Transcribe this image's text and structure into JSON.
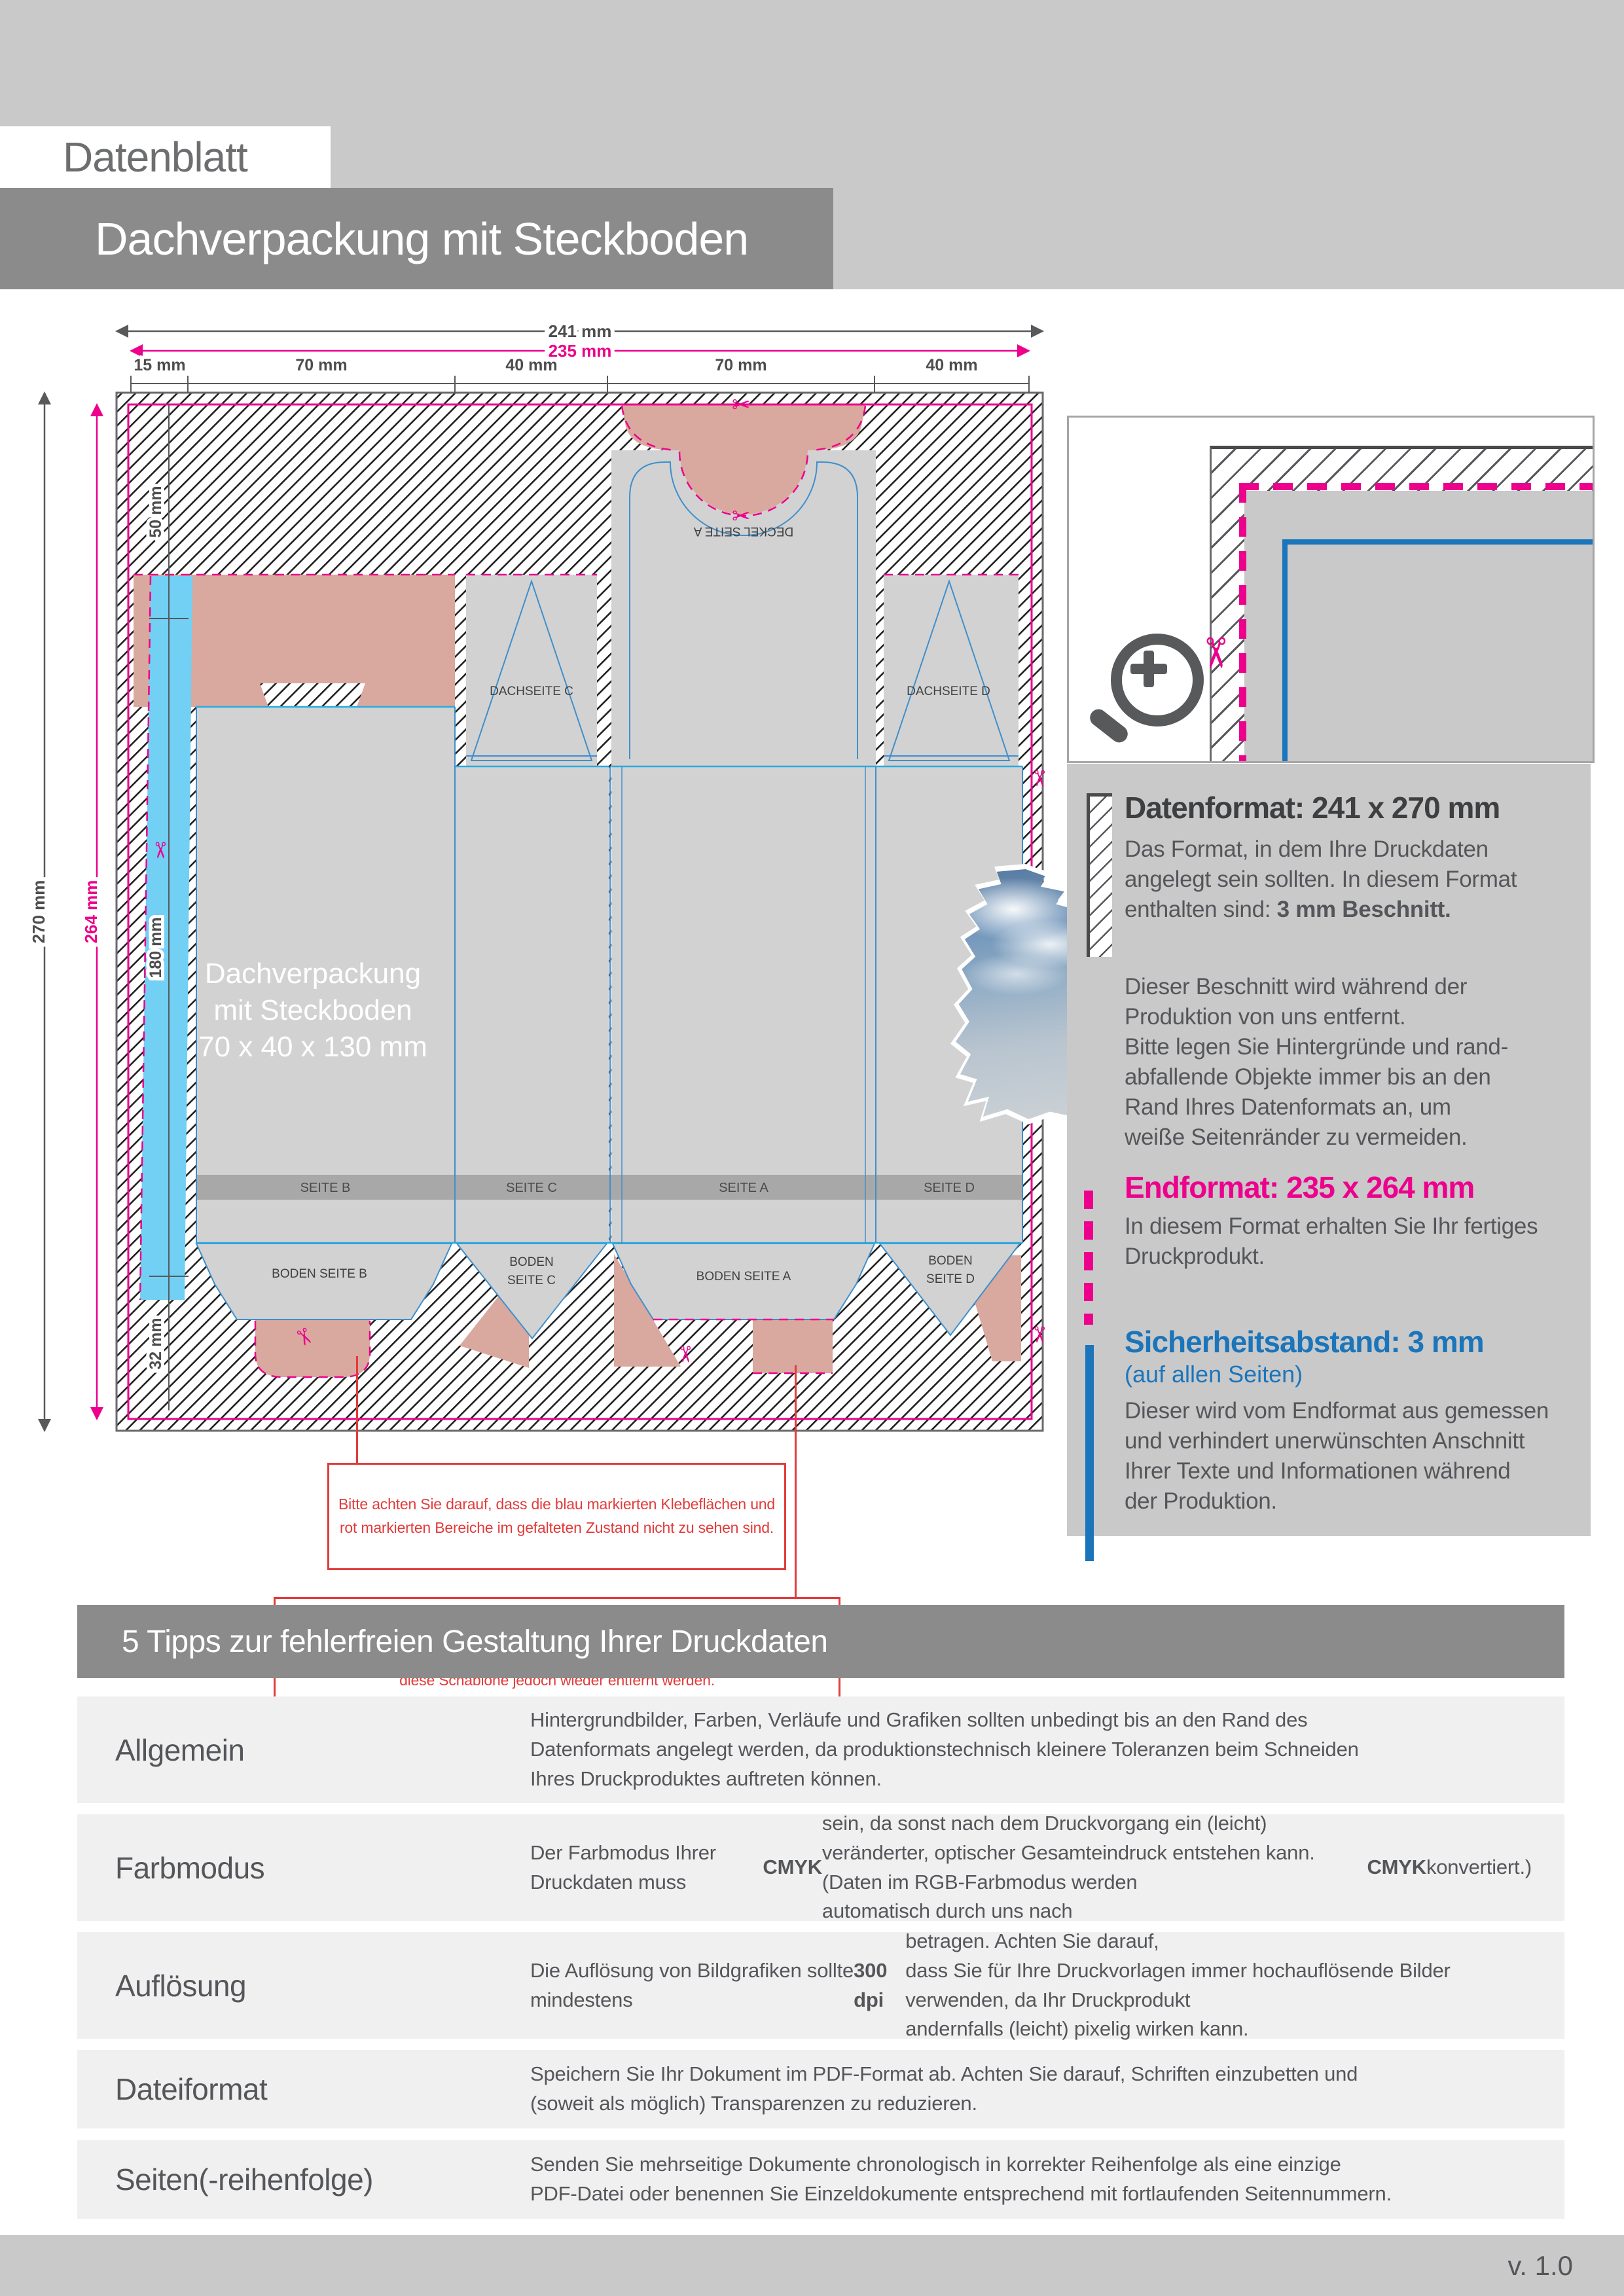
{
  "header": {
    "doc_type": "Datenblatt",
    "product_title": "Dachverpackung mit Steckboden"
  },
  "icons": {
    "scissors": "✂"
  },
  "dieline": {
    "dims": {
      "total_width": "241 mm",
      "format_width": "235 mm",
      "segments_top": [
        "15 mm",
        "70 mm",
        "40 mm",
        "70 mm",
        "40 mm"
      ],
      "total_height": "270 mm",
      "format_height": "264 mm",
      "segments_left": [
        "50 mm",
        "180 mm",
        "32 mm"
      ]
    },
    "product_label": {
      "line1": "Dachverpackung",
      "line2": "mit Steckboden",
      "line3": "70 x 40 x 130 mm"
    },
    "panels": {
      "deckel_a": "DECKEL SEITE A",
      "dach_c": "DACHSEITE C",
      "dach_d": "DACHSEITE D",
      "seite_b": "SEITE B",
      "seite_c": "SEITE C",
      "seite_a": "SEITE A",
      "seite_d": "SEITE D",
      "boden_b": "BODEN SEITE B",
      "boden_c_line1": "BODEN",
      "boden_c_line2": "SEITE C",
      "boden_a": "BODEN SEITE A",
      "boden_d_line1": "BODEN",
      "boden_d_line2": "SEITE D"
    }
  },
  "notes": {
    "note1": "Bitte achten Sie darauf, dass die blau markierten Klebeflächen und\nrot markierten Bereiche im gefalteten Zustand nicht zu sehen sind.",
    "note2": "Aufgrund der Komplexität empfehlen wir Ihnen die \"Druckvorlage (zur freien\nVerwendung)\" als Schablone zu nutzen. Bevor Sie uns Ihre Datei zusenden, muss\ndiese Schablone jedoch wieder entfernt werden."
  },
  "info": {
    "datenformat": {
      "title": "Datenformat: 241 x 270 mm",
      "body": [
        {
          "text": "Das Format, in dem Ihre Druckdaten\nangelegt sein sollten. In diesem Format\nenthalten sind: "
        },
        {
          "text": "3 mm Beschnitt.",
          "bold": true
        }
      ],
      "body2": "Dieser Beschnitt wird während der\nProduktion von uns entfernt.\nBitte legen Sie Hintergründe und rand-\nabfallende Objekte immer bis an den\nRand Ihres Datenformats an, um\nweiße Seitenränder zu vermeiden."
    },
    "endformat": {
      "title": "Endformat: 235 x 264 mm",
      "body": "In diesem Format erhalten Sie Ihr fertiges\nDruckprodukt."
    },
    "sicherheitsabstand": {
      "title": "Sicherheitsabstand: 3 mm",
      "subtitle": "(auf allen Seiten)",
      "body": "Dieser wird vom Endformat aus gemessen\nund verhindert unerwünschten Anschnitt\nIhrer Texte und Informationen während\nder Produktion."
    }
  },
  "tips": {
    "title": "5 Tipps zur fehlerfreien Gestaltung Ihrer Druckdaten",
    "rows": [
      {
        "label": "Allgemein",
        "text": [
          {
            "text": "Hintergrundbilder, Farben, Verläufe und Grafiken sollten unbedingt bis an den Rand des\nDatenformats angelegt werden, da produktionstechnisch kleinere Toleranzen beim Schneiden\nIhres Druckproduktes auftreten können."
          }
        ]
      },
      {
        "label": "Farbmodus",
        "text": [
          {
            "text": "Der Farbmodus Ihrer Druckdaten muss "
          },
          {
            "text": "CMYK",
            "bold": true
          },
          {
            "text": " sein, da sonst nach dem Druckvorgang ein (leicht)\nveränderter, optischer Gesamteindruck entstehen kann. (Daten im RGB-Farbmodus werden\nautomatisch durch uns nach "
          },
          {
            "text": "CMYK",
            "bold": true
          },
          {
            "text": " konvertiert.)"
          }
        ]
      },
      {
        "label": "Auflösung",
        "text": [
          {
            "text": "Die Auflösung von Bildgrafiken sollte mindestens "
          },
          {
            "text": "300 dpi",
            "bold": true
          },
          {
            "text": " betragen. Achten Sie darauf,\ndass Sie für Ihre Druckvorlagen immer hochauflösende Bilder verwenden, da Ihr Druckprodukt\nandernfalls (leicht) pixelig wirken kann."
          }
        ]
      },
      {
        "label": "Dateiformat",
        "text": [
          {
            "text": "Speichern Sie Ihr Dokument im PDF-Format ab. Achten Sie darauf, Schriften einzubetten und\n(soweit als möglich) Transparenzen zu reduzieren."
          }
        ]
      },
      {
        "label": "Seiten(-reihenfolge)",
        "text": [
          {
            "text": "Senden Sie mehrseitige Dokumente chronologisch in korrekter Reihenfolge als eine einzige\nPDF-Datei oder benennen Sie Einzeldokumente entsprechend mit fortlaufenden Seitennummern."
          }
        ]
      }
    ]
  },
  "footer": {
    "version": "v. 1.0"
  },
  "colors": {
    "accent_magenta": "#ec008c",
    "accent_blue": "#1b75bb",
    "warning_red": "#e23b3b",
    "glue_cyan": "#71d0f3",
    "marked_salmon": "#d9a89e",
    "band_gray": "#8b8b8b",
    "page_gray": "#c9c9c9"
  }
}
